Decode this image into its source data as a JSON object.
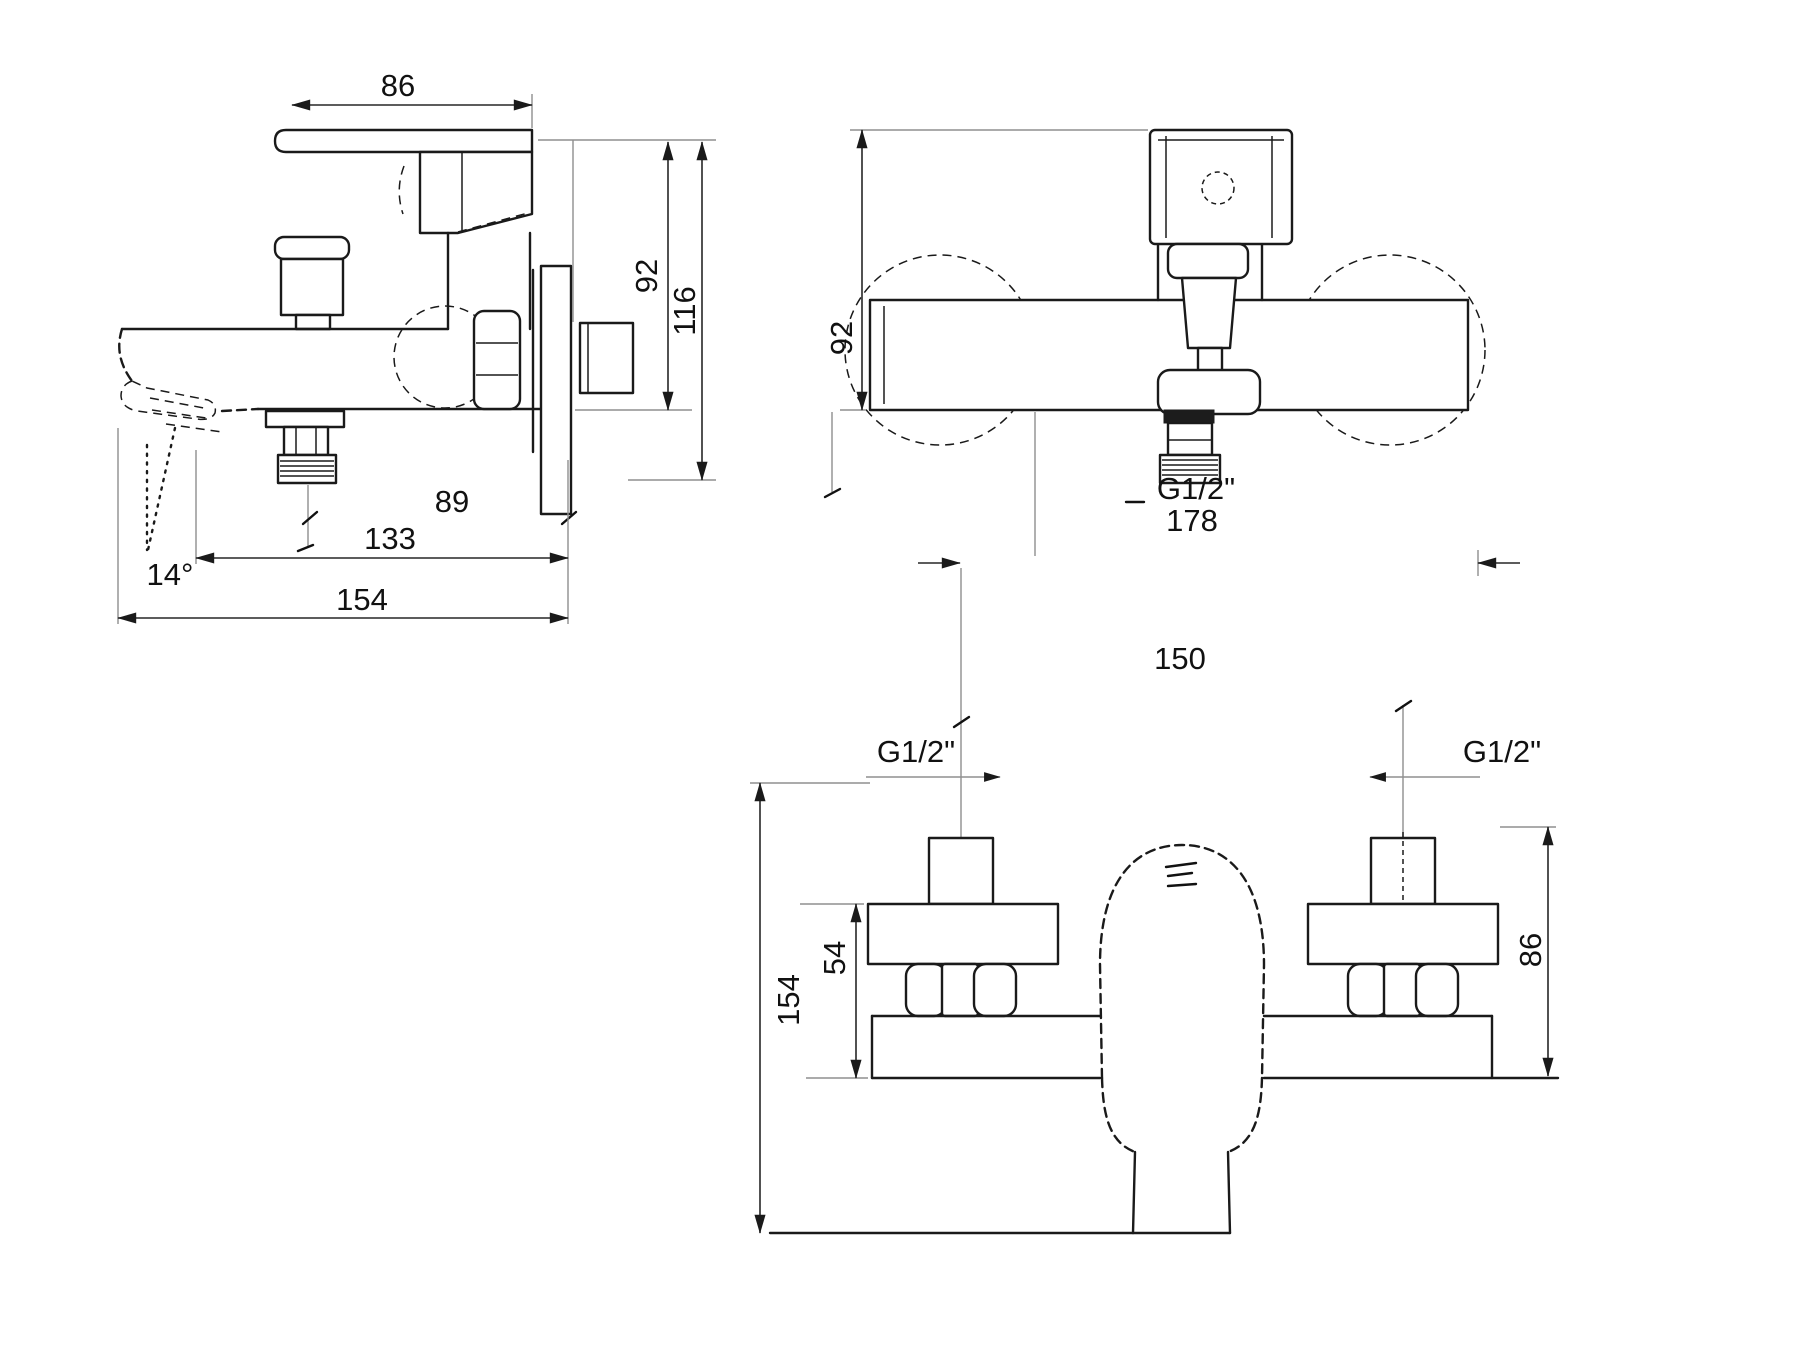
{
  "page": {
    "background": "#ffffff",
    "ink": "#1a1a1a",
    "extension_line_color": "#8f8f8f"
  },
  "diagram": {
    "type": "technical-drawing",
    "subject": "Wall-mounted single-lever bath/shower mixer tap, dimensional drawing with three orthographic views",
    "units": "mm",
    "views": [
      {
        "id": "side",
        "title": "side-profile-view",
        "dimensions": [
          {
            "name": "handle-length",
            "value": "86"
          },
          {
            "name": "height-to-body-bottom",
            "value": "92"
          },
          {
            "name": "overall-height",
            "value": "116"
          },
          {
            "name": "outlet-to-wall",
            "value": "89"
          },
          {
            "name": "spout-reach",
            "value": "133"
          },
          {
            "name": "overall-reach",
            "value": "154"
          }
        ],
        "angle": {
          "name": "spout-angle",
          "value": "14°"
        }
      },
      {
        "id": "front",
        "title": "front-view",
        "dimensions": [
          {
            "name": "mounting-height",
            "value": "92"
          },
          {
            "name": "overall-width",
            "value": "178"
          },
          {
            "name": "connection-spacing",
            "value": "150"
          }
        ],
        "thread": {
          "name": "shower-outlet-thread",
          "value": "G1/2\""
        }
      },
      {
        "id": "plan",
        "title": "bottom-plan-view",
        "dimensions": [
          {
            "name": "escutcheon-depth",
            "value": "54"
          },
          {
            "name": "overall-depth",
            "value": "154"
          },
          {
            "name": "body-width",
            "value": "86"
          }
        ],
        "threads": [
          {
            "name": "left-inlet-thread",
            "value": "G1/2\""
          },
          {
            "name": "right-inlet-thread",
            "value": "G1/2\""
          }
        ]
      }
    ]
  }
}
